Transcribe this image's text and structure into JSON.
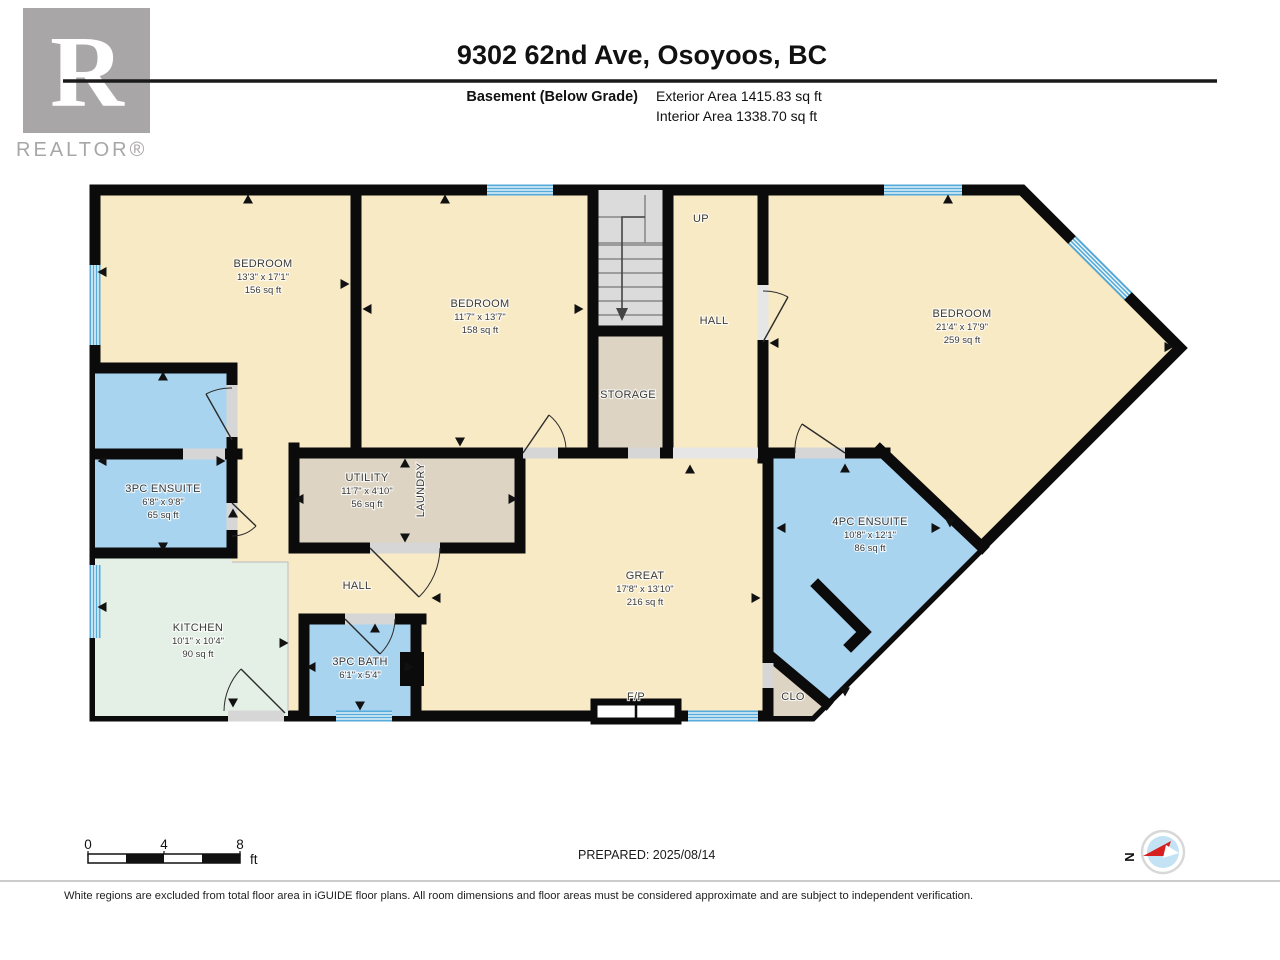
{
  "header": {
    "brand_letter": "R",
    "brand_name": "REALTOR®",
    "title": "9302 62nd Ave, Osoyoos, BC",
    "floor_label": "Basement (Below Grade)",
    "exterior_area": "Exterior Area 1415.83 sq ft",
    "interior_area": "Interior Area 1338.70 sq ft"
  },
  "rooms": {
    "bedroom1": {
      "name": "BEDROOM",
      "dims": "13'3\" x 17'1\"",
      "area": "156 sq ft"
    },
    "bedroom2": {
      "name": "BEDROOM",
      "dims": "11'7\" x 13'7\"",
      "area": "158 sq ft"
    },
    "bedroom3": {
      "name": "BEDROOM",
      "dims": "21'4\" x 17'9\"",
      "area": "259 sq ft"
    },
    "ensuite3pc": {
      "name": "3PC ENSUITE",
      "dims": "6'8\" x 9'8\"",
      "area": "65 sq ft"
    },
    "utility": {
      "name": "UTILITY",
      "dims": "11'7\" x 4'10\"",
      "area": "56 sq ft"
    },
    "laundry": {
      "name": "LAUNDRY"
    },
    "storage": {
      "name": "STORAGE"
    },
    "hall_upper": {
      "name": "HALL"
    },
    "hall_lower": {
      "name": "HALL"
    },
    "stairs_up": {
      "name": "UP"
    },
    "kitchen": {
      "name": "KITCHEN",
      "dims": "10'1\" x 10'4\"",
      "area": "90 sq ft"
    },
    "bath3pc": {
      "name": "3PC BATH",
      "dims": "6'1\" x 5'4\""
    },
    "great": {
      "name": "GREAT",
      "dims": "17'8\" x 13'10\"",
      "area": "216 sq ft"
    },
    "ensuite4pc": {
      "name": "4PC ENSUITE",
      "dims": "10'8\" x 12'1\"",
      "area": "86 sq ft"
    },
    "closet": {
      "name": "CLO"
    },
    "fireplace": {
      "name": "F/P"
    }
  },
  "footer": {
    "scale_ticks": {
      "zero": "0",
      "four": "4",
      "eight": "8"
    },
    "scale_unit": "ft",
    "prepared": "PREPARED: 2025/08/14",
    "compass": "N",
    "disclaimer": "White regions are excluded from total floor area in iGUIDE floor plans. All room dimensions and floor areas must be considered approximate and are subject to independent verification."
  },
  "colors": {
    "room_warm": "#F7EAC4",
    "room_wet": "#A9D4F0",
    "room_kitchen": "#E4F0E5",
    "room_service": "#DDD4C3",
    "stairs": "#DBDBDB",
    "window": "#55ABDA",
    "wall": "#0B0B0B"
  }
}
